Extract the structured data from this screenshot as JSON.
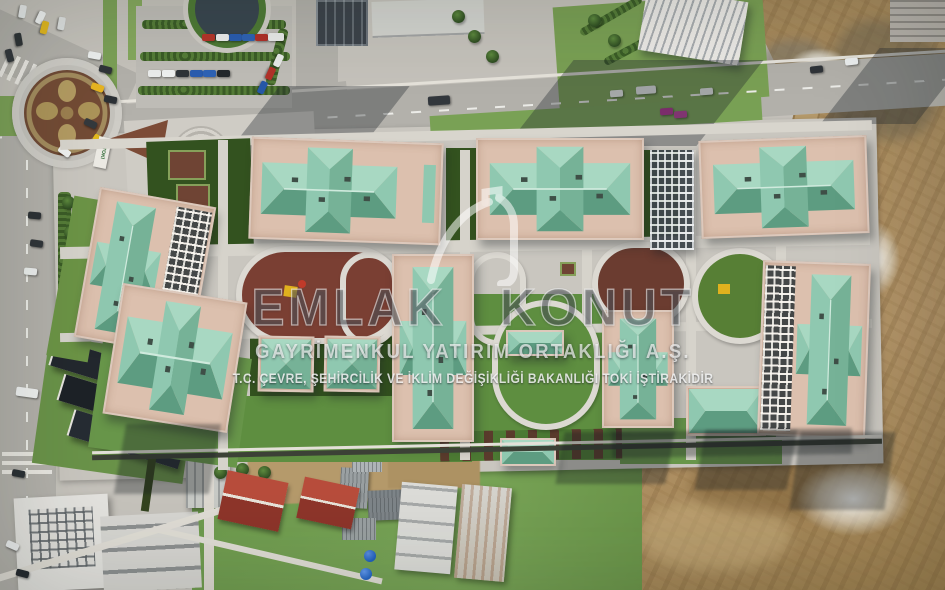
{
  "image": {
    "type": "aerial-drone-photograph",
    "subject": "Top-down aerial view of an Emlak Konut residential complex: eight pink apartment blocks with teal hipped roofs around oval courtyards, a roundabout and parking at top-left, and brown construction earthworks on the right and bottom"
  },
  "watermark": {
    "logo_icon": "emlak-konut-house-swoosh-icon",
    "brand_line": "EMLAK KONUT",
    "subtitle_line": "GAYRİMENKUL YATIRIM ORTAKLIĞI A.Ş.",
    "disclaimer_line": "T.C. ÇEVRE, ŞEHİRCİLİK VE İKLİM DEĞİŞİKLİĞİ BAKANLIĞI TOKİ İŞTİRAKİDİR"
  },
  "signs": {
    "roadside_sign": "TOKİ"
  },
  "palette": {
    "concrete": "#c6c3bc",
    "wall_pink": "#dcc0ae",
    "roof_light": "#a8d8c2",
    "roof_mid": "#8fc8b0",
    "roof_mid2": "#76b297",
    "roof_dark": "#5d9c81",
    "lawn_dark": "#33521f",
    "grass": "#6f9b4e",
    "dirt": "#a5885a",
    "playground_red": "#7a3f33",
    "debris_white": "#e8e6e2"
  }
}
